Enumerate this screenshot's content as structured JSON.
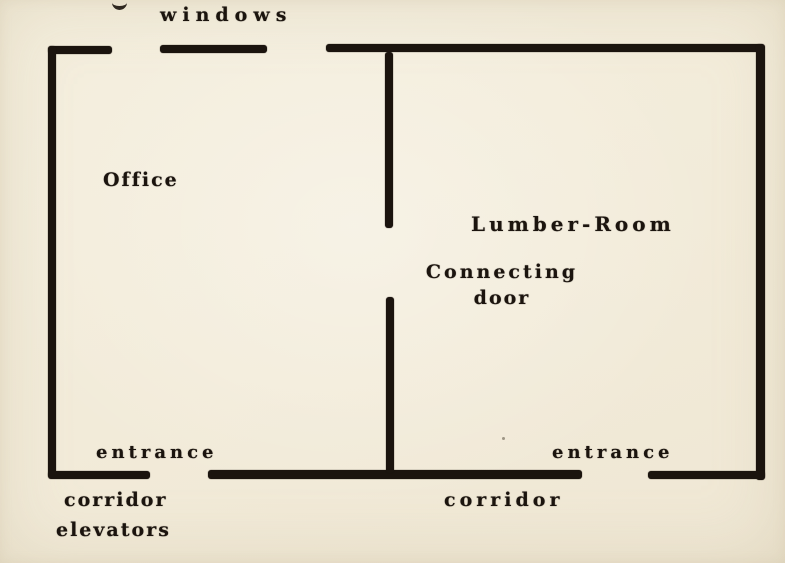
{
  "palette": {
    "paper": "#f2ebd9",
    "ink": "#1b140e"
  },
  "plan": {
    "rooms": {
      "office": {
        "label": "Office"
      },
      "lumber_room": {
        "label": "Lumber-Room"
      }
    },
    "features": {
      "windows": {
        "label": "windows"
      },
      "connecting_door": {
        "label_line1": "Connecting",
        "label_line2": "door"
      },
      "entrance_left": {
        "label": "entrance"
      },
      "entrance_right": {
        "label": "entrance"
      },
      "corridor_left": {
        "label": "corridor"
      },
      "elevators": {
        "label": "elevators"
      },
      "corridor_bottom": {
        "label": "corridor"
      }
    }
  }
}
